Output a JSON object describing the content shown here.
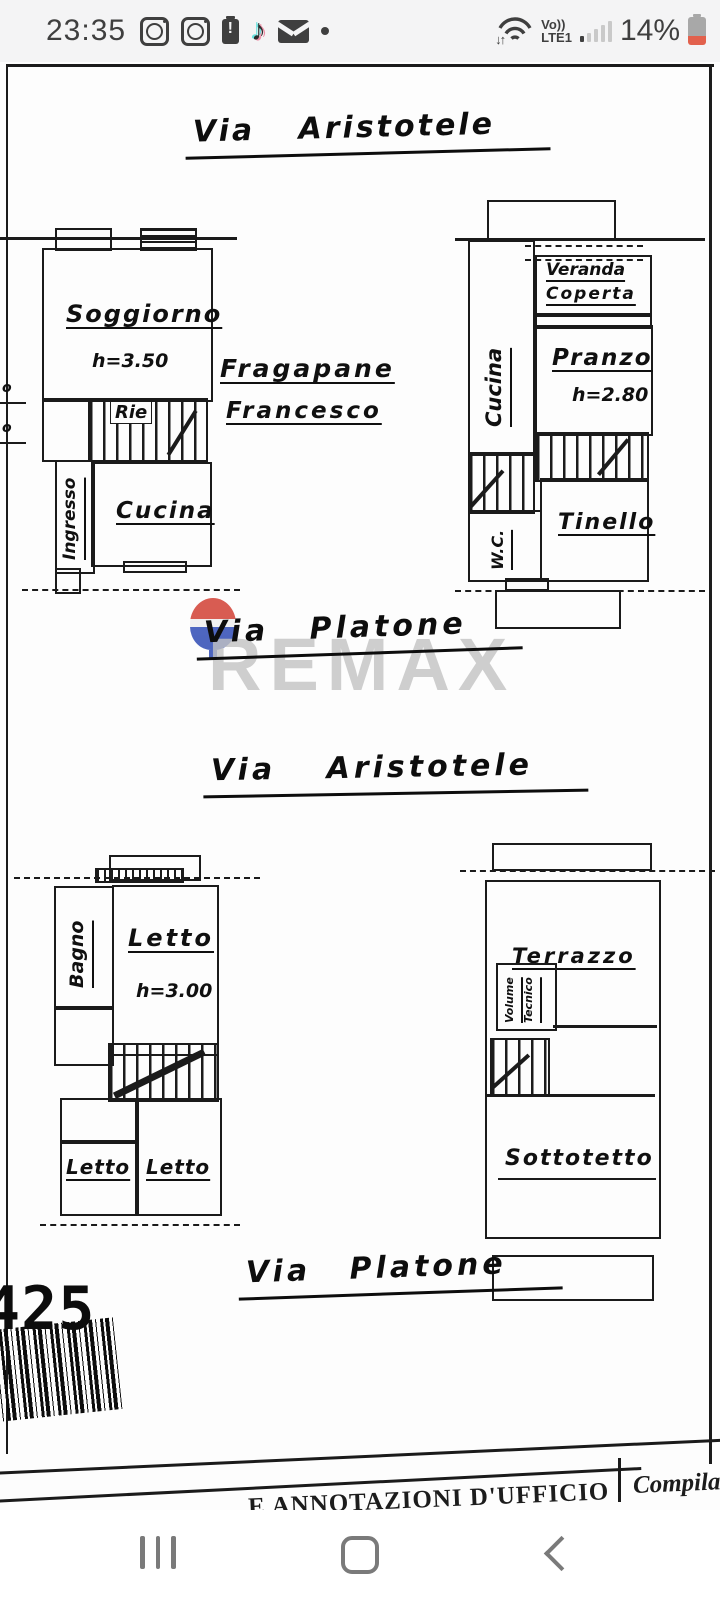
{
  "status_bar": {
    "time": "23:35",
    "battery_percent": "14%",
    "network": {
      "volte_top": "Vo))",
      "volte_bottom": "LTE1"
    },
    "left_icons": [
      "instagram",
      "instagram",
      "battery-alert",
      "tiktok",
      "gmail",
      "more-dot"
    ],
    "right_icons": [
      "wifi",
      "signal-bars",
      "battery"
    ]
  },
  "document": {
    "title_top": "Via Aristotele",
    "title_platone_1": "Via Platone",
    "title_aristotele_2": "Via Aristotele",
    "title_platone_2": "Via Platone",
    "owner_line1": "Fragapane",
    "owner_line2": "Francesco",
    "watermark_text": "REMAX",
    "margin_mark": "o",
    "plans": {
      "upper_left": {
        "soggiorno": "Soggiorno",
        "soggiorno_h": "h=3.50",
        "stair_label": "Rie",
        "ingresso": "Ingresso",
        "cucina": "Cucina"
      },
      "upper_right": {
        "cucina": "Cucina",
        "veranda_line1": "Veranda",
        "veranda_line2": "Coperta",
        "pranzo": "Pranzo",
        "pranzo_h": "h=2.80",
        "wc": "W.C.",
        "tinello": "Tinello"
      },
      "lower_left": {
        "bagno": "Bagno",
        "letto_main": "Letto",
        "letto_h": "h=3.00",
        "letto_small": "Letto",
        "letto_big": "Letto"
      },
      "lower_right": {
        "terrazzo": "Terrazzo",
        "volume_line1": "Volume",
        "volume_line2": "Tecnico",
        "sottotetto": "Sottotetto"
      }
    },
    "barcode_number": "425",
    "footer_center": "E ANNOTAZIONI D'UFFICIO",
    "footer_right": "Compilat"
  },
  "nav_bar": {
    "buttons": [
      "recents",
      "home",
      "back"
    ]
  },
  "colors": {
    "ink": "#1b1b1b",
    "status_foreground": "#3f3f3f",
    "battery_low_red": "#e2614d",
    "tiktok_teal": "#6be0dd",
    "tiktok_pink": "#eb8ea6",
    "remax_gray": "#c3c3c3",
    "remax_balloon_red": "#d23f34",
    "remax_balloon_blue": "#2f4bb5",
    "nav_icon_gray": "#7a7a7a"
  }
}
